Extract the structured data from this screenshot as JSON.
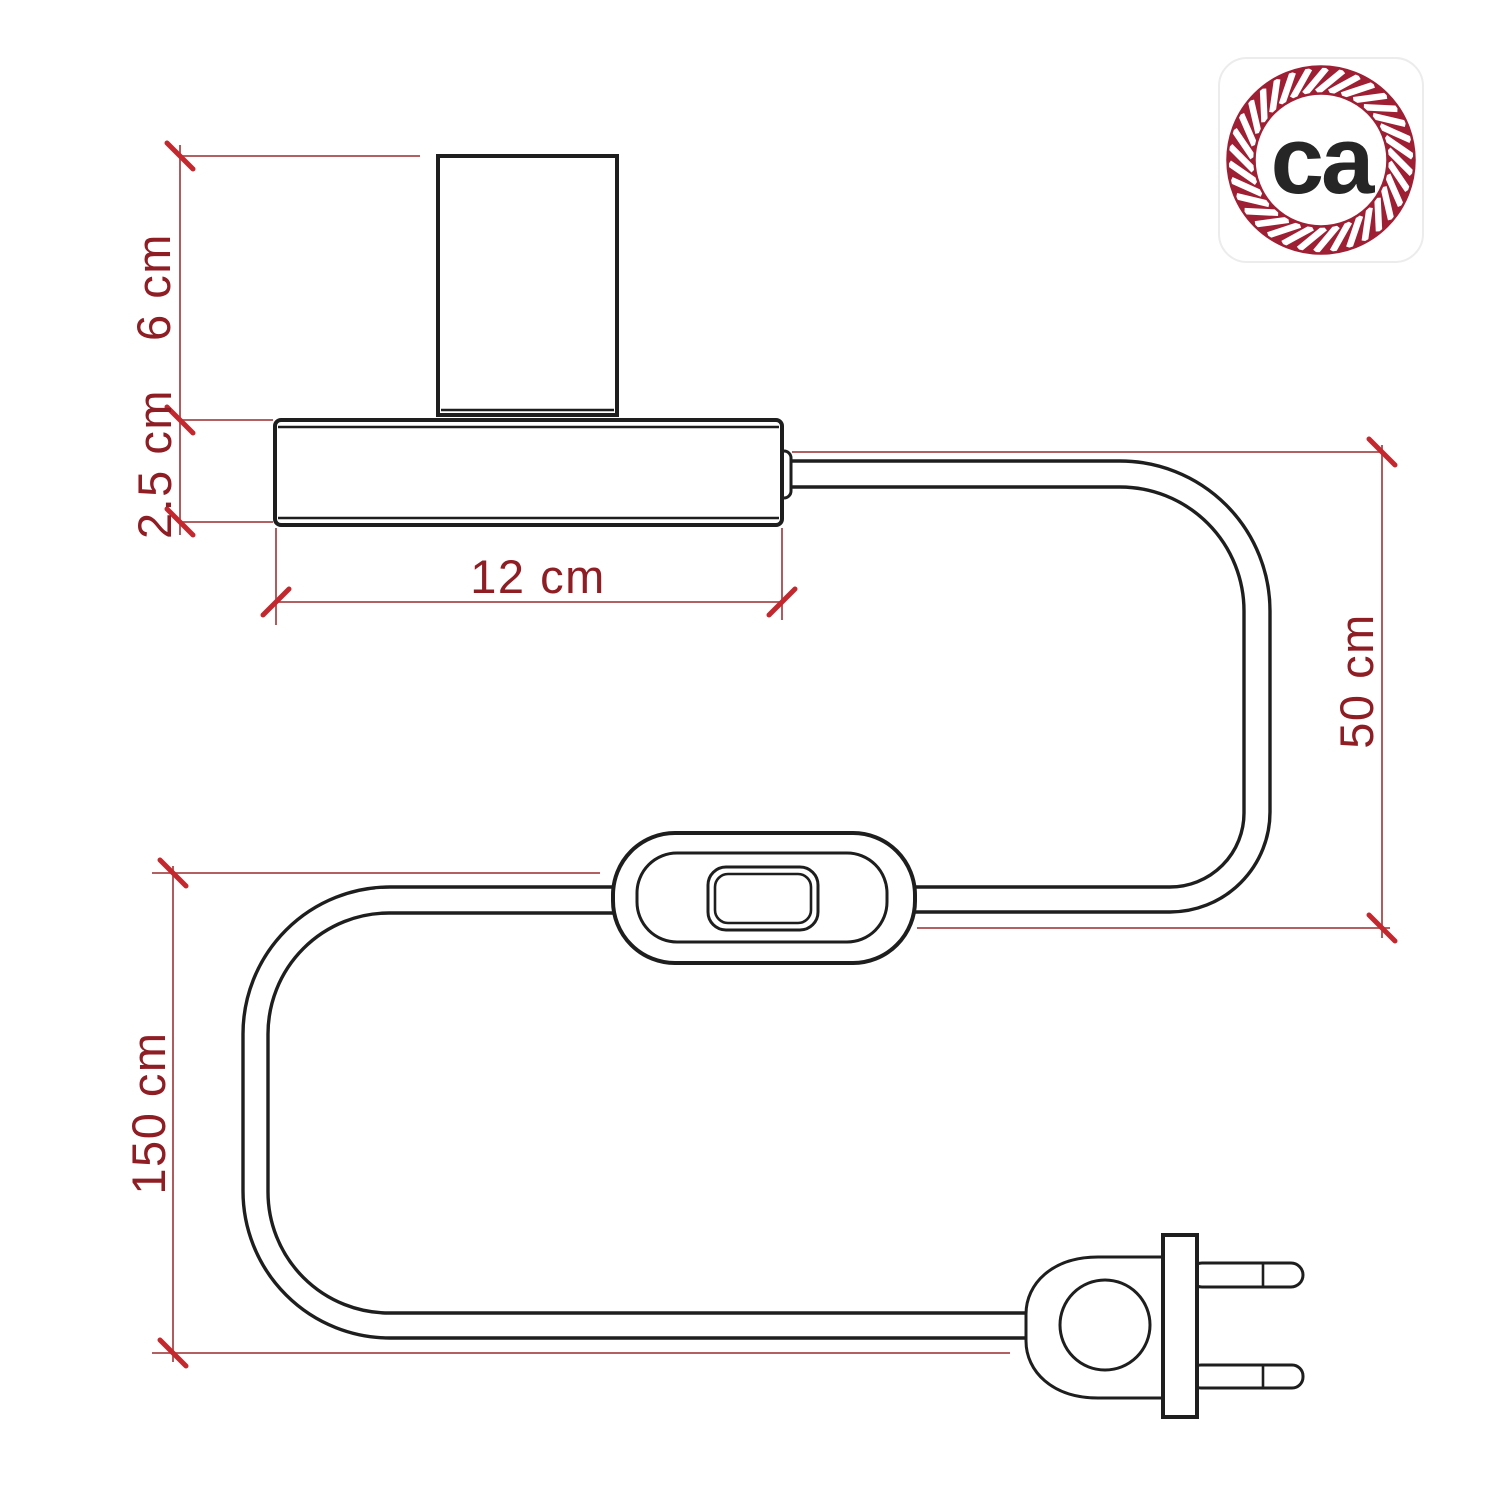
{
  "dimensions": {
    "socket_height": {
      "label": "6 cm",
      "orientation": "vertical"
    },
    "base_height": {
      "label": "2.5 cm",
      "orientation": "vertical"
    },
    "base_width": {
      "label": "12 cm",
      "orientation": "horizontal"
    },
    "base_to_switch_drop": {
      "label": "50 cm",
      "orientation": "vertical"
    },
    "total_cable_length": {
      "label": "150 cm",
      "orientation": "vertical"
    }
  },
  "logo": {
    "text": "ca"
  },
  "colors": {
    "drawing_ink": "#1e1e1e",
    "dimension_line": "#a8494b",
    "dimension_tick": "#c2282d",
    "dimension_text": "#8e1d24",
    "logo_rope": "#9e1f33",
    "logo_text": "#262626"
  }
}
